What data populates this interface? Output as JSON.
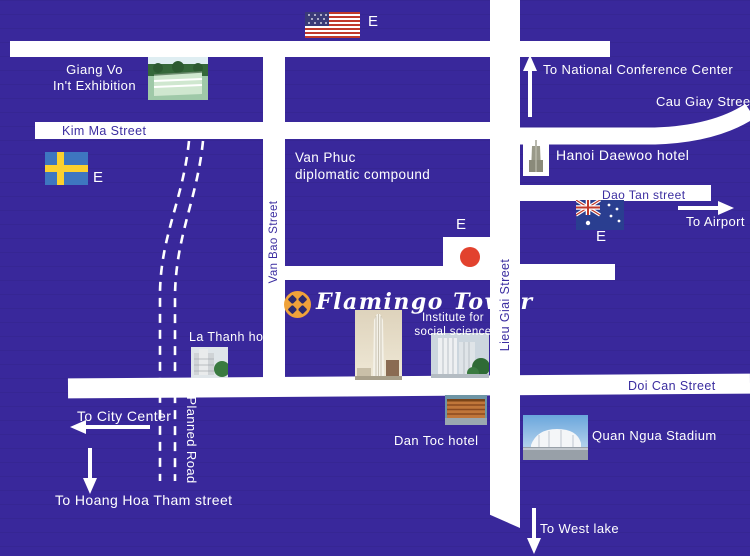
{
  "map": {
    "colors": {
      "background": "#39289b",
      "road": "#ffffff",
      "dark_label": "#3b2da0",
      "logo_orange": "#efa23a",
      "logo_navy": "#2c2a6e",
      "japan_red": "#e2422e"
    }
  },
  "logo": {
    "title": "Flamingo Tower"
  },
  "streets": {
    "kim_ma": "Kim Ma Street",
    "van_bao": "Van Bao Street",
    "lieu_giai": "Lieu Giai Street",
    "dao_tan": "Dao Tan street",
    "cau_giay": "Cau Giay Street",
    "doi_can": "Doi Can Street",
    "planned": "Planned Road"
  },
  "places": {
    "giang_vo_line1": "Giang Vo",
    "giang_vo_line2": "In't Exhibition",
    "van_phuc_line1": "Van Phuc",
    "van_phuc_line2": "diplomatic compound",
    "daewoo": "Hanoi Daewoo hotel",
    "la_thanh": "La Thanh hotel",
    "institute_line1": "Institute for",
    "institute_line2": "social science",
    "dan_toc": "Dan Toc hotel",
    "quan_ngua": "Quan Ngua Stadium"
  },
  "directions": {
    "conference": "To National Conference Center",
    "airport": "To Airport",
    "city_center": "To City Center",
    "hoang_hoa_tham": "To Hoang Hoa Tham street",
    "west_lake": "To West lake"
  },
  "embassies": {
    "marker": "E"
  }
}
